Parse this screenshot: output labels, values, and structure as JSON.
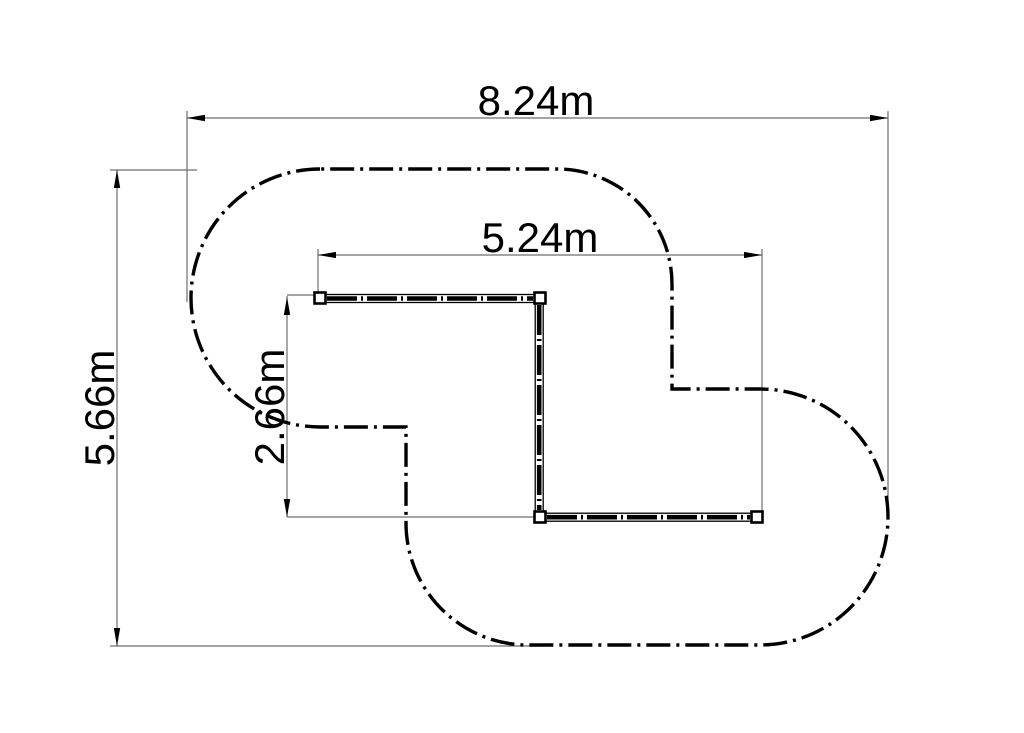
{
  "diagram": {
    "kind": "dimensioned-track-layout-plan",
    "unit": "m",
    "dims": {
      "overall_width": "8.24m",
      "overall_height": "5.66m",
      "track_width": "5.24m",
      "track_height": "2.66m"
    },
    "values": {
      "overall_width_m": 8.24,
      "overall_height_m": 5.66,
      "track_width_m": 5.24,
      "track_height_m": 2.66
    },
    "colors": {
      "ink": "#000000",
      "dim_line": "#6e6e6e",
      "background": "#ffffff"
    }
  }
}
